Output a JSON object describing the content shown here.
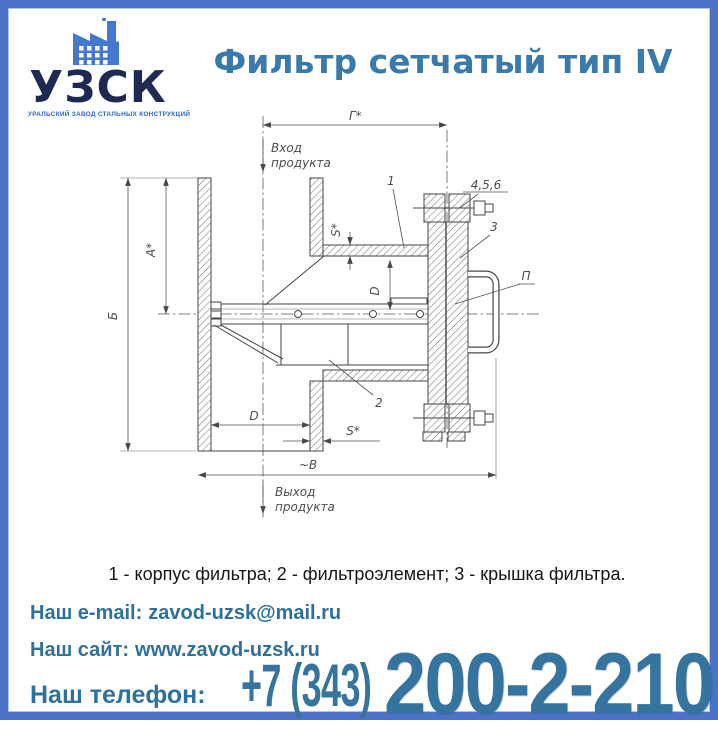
{
  "brand": {
    "name": "УЗСК",
    "tagline": "УРАЛЬСКИЙ ЗАВОД СТАЛЬНЫХ КОНСТРУКЦИЙ"
  },
  "header": {
    "title": "Фильтр сетчатый тип IV"
  },
  "drawing": {
    "inlet": {
      "line1": "Вход",
      "line2": "продукта"
    },
    "outlet": {
      "line1": "Выход",
      "line2": "продукта"
    },
    "dims": {
      "top_length": "Г*",
      "inlet_height": "А*",
      "total_height": "Б",
      "bore": "D",
      "housing_bore": "D",
      "wall_top": "S*",
      "wall_bottom": "S*",
      "base_width": "~В"
    },
    "callouts": {
      "body": "1",
      "element": "2",
      "cover": "3",
      "fasteners": "4,5,6",
      "handle": "П"
    }
  },
  "caption": "1 - корпус фильтра; 2 - фильтроэлемент; 3 - крышка фильтра.",
  "contacts": {
    "email_label": "Наш e-mail:",
    "email": "zavod-uzsk@mail.ru",
    "site_label": "Наш сайт:",
    "site": "www.zavod-uzsk.ru",
    "phone_label": "Наш телефон:",
    "phone_code": "+7 (343)",
    "phone_number": "200-2-210"
  },
  "colors": {
    "frame_border": "#4a72c6",
    "title_accent": "#3a7aab",
    "contact_accent": "#2e719e",
    "phone_accent": "#35749f",
    "brand_navy": "#1e2a52",
    "brand_blue": "#2e68cf",
    "icon_blue": "#4478d1"
  }
}
